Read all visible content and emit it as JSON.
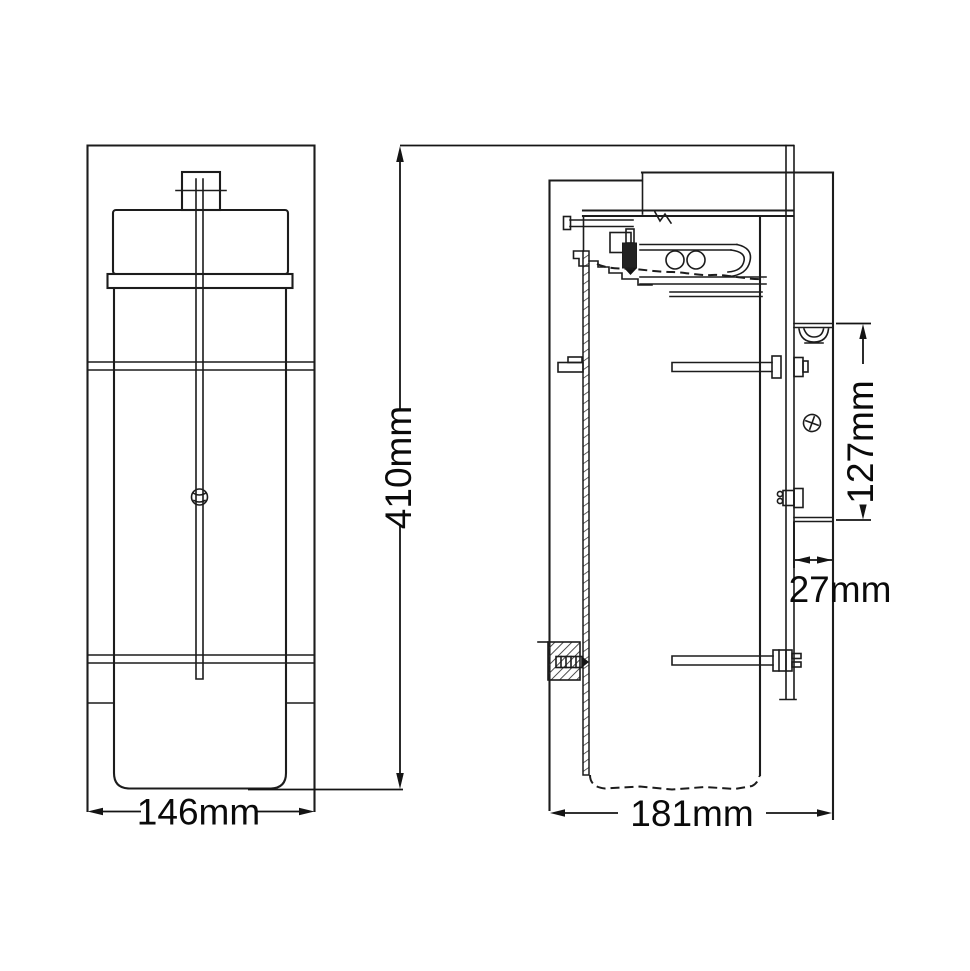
{
  "drawing": {
    "type": "technical-dimension-drawing",
    "subject": "wall-lantern-two-view-section",
    "views": {
      "front_view": "front elevation",
      "side_view": "side section with wall bracket"
    }
  },
  "dimensions": {
    "height": {
      "label": "410mm",
      "orientation": "vertical"
    },
    "front_width": {
      "label": "146mm",
      "orientation": "horizontal"
    },
    "side_depth": {
      "label": "181mm",
      "orientation": "horizontal"
    },
    "bracket_height": {
      "label": "127mm",
      "orientation": "vertical"
    },
    "bracket_depth": {
      "label": "27mm",
      "orientation": "horizontal"
    }
  },
  "colors": {
    "background": "#ffffff",
    "line": "#1c1c1c",
    "text": "#0a0a0a"
  }
}
